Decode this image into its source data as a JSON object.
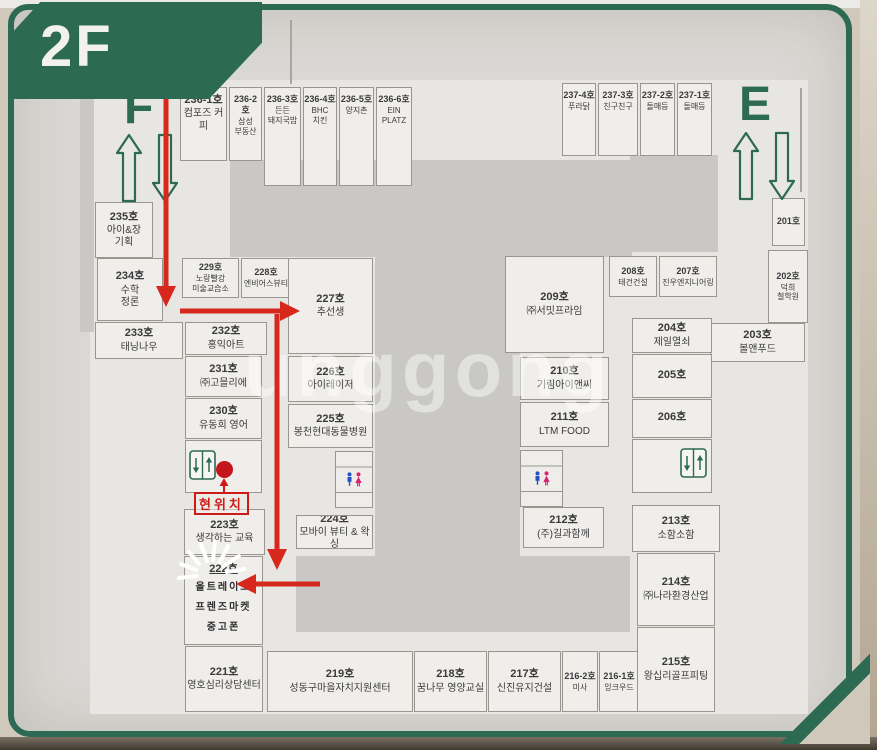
{
  "photo": {
    "floor_badge": "2F"
  },
  "stairwells": {
    "left_label": "F",
    "right_label": "E"
  },
  "current_location_label": "현위치",
  "watermark_text": "unggong",
  "colors": {
    "frame_green": "#2c6a53",
    "route_red": "#d6281c",
    "sign_bg": "#dad8d4",
    "unit_bg": "#f0eeea",
    "corridor_void_gray": "#c9c8c6",
    "restroom_male_blue": "#1f51c8",
    "restroom_female_pink": "#d6256e",
    "current_location_dot": "#c3151c"
  },
  "units": [
    {
      "room": "236-1호",
      "name": "컴포즈 커피",
      "x": 180,
      "y": 87,
      "w": 47,
      "h": 74
    },
    {
      "room": "236-2호",
      "name": "삼성\n부동산",
      "x": 229,
      "y": 87,
      "w": 33,
      "h": 74
    },
    {
      "room": "236-3호",
      "name": "든든\n돼지국밥",
      "x": 264,
      "y": 87,
      "w": 37,
      "h": 99
    },
    {
      "room": "236-4호",
      "name": "BHC\n치킨",
      "x": 303,
      "y": 87,
      "w": 34,
      "h": 99
    },
    {
      "room": "236-5호",
      "name": "양지촌",
      "x": 339,
      "y": 87,
      "w": 35,
      "h": 99
    },
    {
      "room": "236-6호",
      "name": "EIN\nPLATZ",
      "x": 376,
      "y": 87,
      "w": 36,
      "h": 99
    },
    {
      "room": "237-4호",
      "name": "푸라닭",
      "x": 562,
      "y": 83,
      "w": 34,
      "h": 73
    },
    {
      "room": "237-3호",
      "name": "친구친구",
      "x": 598,
      "y": 83,
      "w": 40,
      "h": 73
    },
    {
      "room": "237-2호",
      "name": "돌매등",
      "x": 640,
      "y": 83,
      "w": 35,
      "h": 73
    },
    {
      "room": "237-1호",
      "name": "돌매등",
      "x": 677,
      "y": 83,
      "w": 35,
      "h": 73
    },
    {
      "room": "235호",
      "name": "아이&장\n기획",
      "x": 95,
      "y": 202,
      "w": 58,
      "h": 56
    },
    {
      "room": "234호",
      "name": "수학\n정론",
      "x": 97,
      "y": 258,
      "w": 66,
      "h": 63
    },
    {
      "room": "233호",
      "name": "태닝나우",
      "x": 95,
      "y": 322,
      "w": 88,
      "h": 37
    },
    {
      "room": "232호",
      "name": "홍익아트",
      "x": 185,
      "y": 322,
      "w": 82,
      "h": 33
    },
    {
      "room": "231호",
      "name": "㈜고믈리에",
      "x": 185,
      "y": 356,
      "w": 77,
      "h": 41
    },
    {
      "room": "230호",
      "name": "유동희 영어",
      "x": 185,
      "y": 398,
      "w": 77,
      "h": 41
    },
    {
      "room": "223호",
      "name": "생각하는 교육",
      "x": 184,
      "y": 509,
      "w": 81,
      "h": 46
    },
    {
      "room": "222호",
      "name": "올트레이드\n프렌즈마켓\n중고폰",
      "x": 184,
      "y": 556,
      "w": 79,
      "h": 89
    },
    {
      "room": "221호",
      "name": "영호심리상담센터",
      "x": 185,
      "y": 646,
      "w": 78,
      "h": 66
    },
    {
      "room": "219호",
      "name": "성동구마을자치지원센터",
      "x": 267,
      "y": 651,
      "w": 146,
      "h": 61
    },
    {
      "room": "218호",
      "name": "꿈나무 영양교실",
      "x": 414,
      "y": 651,
      "w": 73,
      "h": 61
    },
    {
      "room": "217호",
      "name": "신진유지건설",
      "x": 488,
      "y": 651,
      "w": 73,
      "h": 61
    },
    {
      "room": "216-2호",
      "name": "미사",
      "x": 562,
      "y": 651,
      "w": 36,
      "h": 61
    },
    {
      "room": "216-1호",
      "name": "잉크우드",
      "x": 599,
      "y": 651,
      "w": 40,
      "h": 61
    },
    {
      "room": "229호",
      "name": "노랑빨강\n미술교습소",
      "x": 182,
      "y": 258,
      "w": 57,
      "h": 40
    },
    {
      "room": "228호",
      "name": "엔비어스뷰티",
      "x": 241,
      "y": 258,
      "w": 50,
      "h": 40
    },
    {
      "room": "227호",
      "name": "추선생",
      "x": 288,
      "y": 258,
      "w": 85,
      "h": 96
    },
    {
      "room": "226호",
      "name": "아이레이저",
      "x": 288,
      "y": 356,
      "w": 85,
      "h": 46
    },
    {
      "room": "225호",
      "name": "봉천현대동물병원",
      "x": 288,
      "y": 404,
      "w": 85,
      "h": 44
    },
    {
      "room": "224호",
      "name": "모바이 뷰티 & 왁싱",
      "x": 296,
      "y": 515,
      "w": 77,
      "h": 34
    },
    {
      "room": "209호",
      "name": "㈜서밋프라임",
      "x": 505,
      "y": 256,
      "w": 99,
      "h": 97
    },
    {
      "room": "210호",
      "name": "기림아이앤씨",
      "x": 520,
      "y": 357,
      "w": 89,
      "h": 43
    },
    {
      "room": "211호",
      "name": "LTM FOOD",
      "x": 520,
      "y": 402,
      "w": 89,
      "h": 45
    },
    {
      "room": "212호",
      "name": "(주)길과함께",
      "x": 523,
      "y": 507,
      "w": 81,
      "h": 41
    },
    {
      "room": "208호",
      "name": "태건건설",
      "x": 609,
      "y": 256,
      "w": 48,
      "h": 41
    },
    {
      "room": "207호",
      "name": "진우엔지니어링",
      "x": 659,
      "y": 256,
      "w": 58,
      "h": 41
    },
    {
      "room": "201호",
      "name": "",
      "x": 772,
      "y": 198,
      "w": 33,
      "h": 48
    },
    {
      "room": "202호",
      "name": "덕희\n철학원",
      "x": 768,
      "y": 250,
      "w": 40,
      "h": 73
    },
    {
      "room": "203호",
      "name": "볼앤푸드",
      "x": 710,
      "y": 323,
      "w": 95,
      "h": 39
    },
    {
      "room": "204호",
      "name": "제일열쇠",
      "x": 632,
      "y": 318,
      "w": 80,
      "h": 35
    },
    {
      "room": "205호",
      "name": "",
      "x": 632,
      "y": 354,
      "w": 80,
      "h": 44
    },
    {
      "room": "206호",
      "name": "",
      "x": 632,
      "y": 399,
      "w": 80,
      "h": 39
    },
    {
      "room": "213호",
      "name": "소함소함",
      "x": 632,
      "y": 505,
      "w": 88,
      "h": 47
    },
    {
      "room": "214호",
      "name": "㈜나라환경산업",
      "x": 637,
      "y": 553,
      "w": 78,
      "h": 73
    },
    {
      "room": "215호",
      "name": "왕십리골프피팅",
      "x": 637,
      "y": 627,
      "w": 78,
      "h": 85
    }
  ]
}
